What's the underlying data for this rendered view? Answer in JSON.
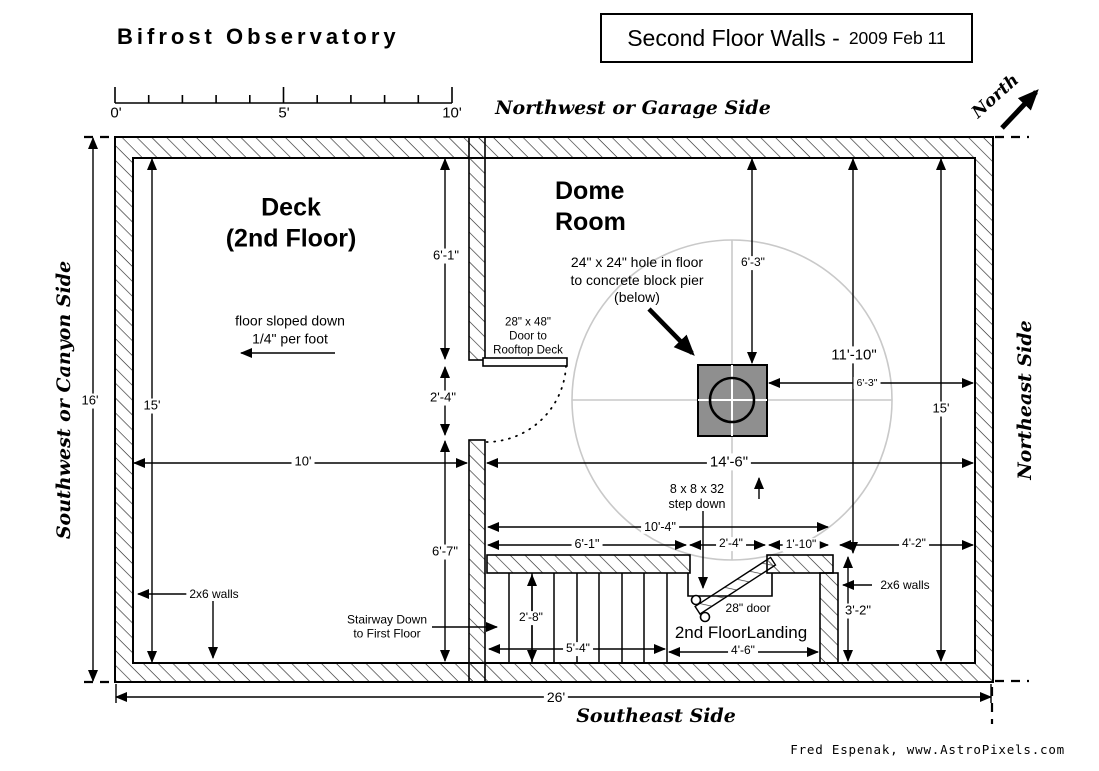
{
  "header": {
    "title": "Bifrost Observatory",
    "box_title": "Second Floor Walls -",
    "box_date": "2009 Feb 11"
  },
  "compass": {
    "north": "North"
  },
  "sides": {
    "top": "Northwest or Garage Side",
    "left": "Southwest or Canyon Side",
    "right": "Northeast Side",
    "bottom": "Southeast Side"
  },
  "scale": {
    "t0": "0'",
    "t5": "5'",
    "t10": "10'"
  },
  "rooms": {
    "deck1": "Deck",
    "deck2": "(2nd Floor)",
    "dome1": "Dome",
    "dome2": "Room",
    "landing": "2nd FloorLanding"
  },
  "notes": {
    "slope1": "floor sloped down",
    "slope2": "1/4\" per foot",
    "hole1": "24\" x 24\" hole in floor",
    "hole2": "to concrete block pier",
    "hole3": "(below)",
    "rdoor1": "28\" x 48\"",
    "rdoor2": "Door to",
    "rdoor3": "Rooftop Deck",
    "stair1": "Stairway Down",
    "stair2": "to First Floor",
    "step1": "8 x 8 x 32",
    "step2": "step down",
    "door28": "28\" door",
    "walls_left": "2x6 walls",
    "walls_right": "2x6 walls"
  },
  "dims": {
    "out_h": "16'",
    "in_left": "15'",
    "deck_top": "6'-1\"",
    "door_open": "2'-4\"",
    "deck_bot": "6'-7\"",
    "deck_w": "10'",
    "dome_w": "14'-6\"",
    "pier_top": "6'-3\"",
    "pier_right": "6'-3\"",
    "dome_right": "11'-10\"",
    "in_right": "15'",
    "mid_total": "10'-4\"",
    "mid_a": "6'-1\"",
    "mid_b": "2'-4\"",
    "mid_c": "1'-10\"",
    "mid_d": "4'-2\"",
    "stair_h": "2'-8\"",
    "stair_w": "5'-4\"",
    "landing_w": "4'-6\"",
    "landing_h": "3'-2\"",
    "out_w": "26'"
  },
  "footer": {
    "credit": "Fred Espenak, www.AstroPixels.com"
  },
  "colors": {
    "ink": "#000000",
    "pier_fill": "#8f8f8f",
    "dome_line": "#c9c9c9"
  }
}
